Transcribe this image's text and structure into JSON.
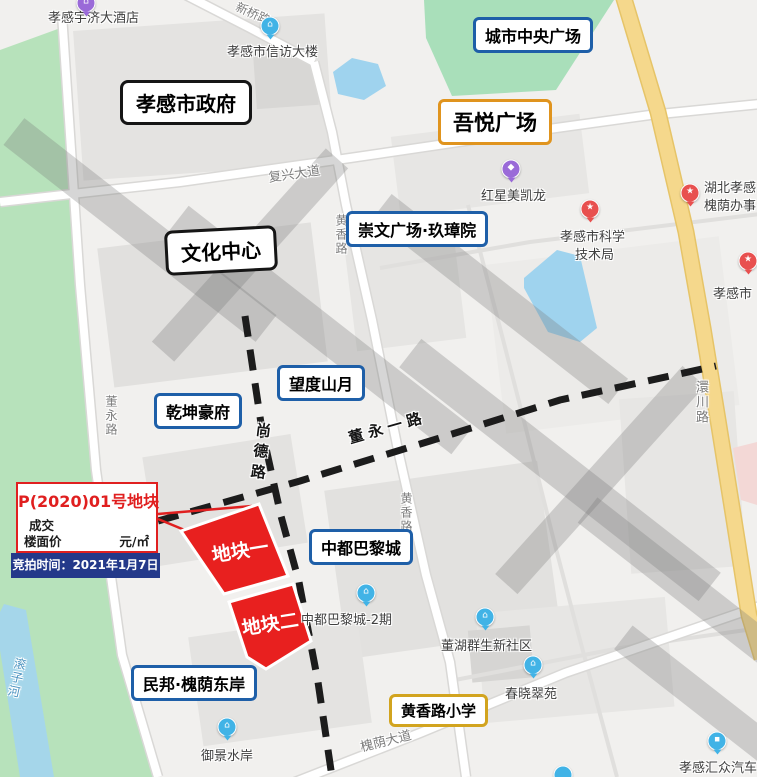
{
  "boxed_labels": [
    {
      "id": "xiaogan-government",
      "label": "孝感市政府",
      "style": "black"
    },
    {
      "id": "city-central-plaza",
      "label": "城市中央广场",
      "style": "blue"
    },
    {
      "id": "wuyue-plaza",
      "label": "吾悦广场",
      "style": "orange"
    },
    {
      "id": "culture-center",
      "label": "文化中心",
      "style": "black"
    },
    {
      "id": "chongwen-plaza-jiuzhangyuan",
      "label": "崇文广场·玖璋院",
      "style": "blue"
    },
    {
      "id": "wangdu-shanyue",
      "label": "望度山月",
      "style": "blue"
    },
    {
      "id": "qiankun-haofu",
      "label": "乾坤豪府",
      "style": "blue"
    },
    {
      "id": "zhongdu-paris-city",
      "label": "中都巴黎城",
      "style": "blue"
    },
    {
      "id": "minbang-huaiyin-east-bank",
      "label": "民邦·槐荫东岸",
      "style": "blue"
    },
    {
      "id": "huangxiang-road-primary-school",
      "label": "黄香路小学",
      "style": "gold"
    }
  ],
  "road_labels": [
    {
      "id": "xinqiao-road",
      "label": "新桥路"
    },
    {
      "id": "fuxing-avenue",
      "label": "复兴大道"
    },
    {
      "id": "dongyong-road",
      "label": "董永路"
    },
    {
      "id": "shangde-road",
      "label": "尚德路"
    },
    {
      "id": "dongyong-no1-road",
      "label": "董永一路"
    },
    {
      "id": "huangxiang-road-north",
      "label": "黄香路"
    },
    {
      "id": "huangxiang-road-south",
      "label": "黄香路"
    },
    {
      "id": "huanchuan-road",
      "label": "澴川路"
    },
    {
      "id": "huaiyin-avenue",
      "label": "槐荫大道"
    },
    {
      "id": "gunzi-river",
      "label": "滚子河"
    }
  ],
  "pois": [
    {
      "id": "yuji-grand-hotel",
      "label": "孝感宇济大酒店",
      "icon": "building",
      "pin": "purple"
    },
    {
      "id": "xinfang-building",
      "label": "孝感市信访大楼",
      "icon": "building",
      "pin": "blue"
    },
    {
      "id": "red-star-macalline",
      "label": "红星美凯龙",
      "icon": "bag",
      "pin": "purple"
    },
    {
      "id": "science-tech-bureau",
      "label": "孝感市科学",
      "label2": "技术局",
      "icon": "star",
      "pin": "red"
    },
    {
      "id": "huaiyin-office",
      "label": "湖北孝感",
      "label2": "槐荫办事",
      "icon": "star",
      "pin": "red"
    },
    {
      "id": "xiaogan-city-poi",
      "label": "孝感市",
      "icon": "star",
      "pin": "red"
    },
    {
      "id": "zhongdu-paris-phase2",
      "label": "中都巴黎城-2期",
      "icon": "building",
      "pin": "blue"
    },
    {
      "id": "donghu-qunsheng-community",
      "label": "董湖群生新社区",
      "icon": "building",
      "pin": "blue"
    },
    {
      "id": "chunxiao-cuiyuan",
      "label": "春晓翠苑",
      "icon": "building",
      "pin": "blue"
    },
    {
      "id": "yujing-shuian",
      "label": "御景水岸",
      "icon": "building",
      "pin": "blue"
    },
    {
      "id": "xiaogan-huizhong-auto",
      "label": "孝感汇众汽车",
      "icon": "car",
      "pin": "blue"
    }
  ],
  "parcels": [
    {
      "id": "parcel-1",
      "label": "地块一"
    },
    {
      "id": "parcel-2",
      "label": "地块二"
    }
  ],
  "legend": {
    "title": "P(2020)01号地块",
    "line1": "成交",
    "line2": "楼面价",
    "unit": "元/㎡",
    "auction": "竞拍时间：2021年1月7日"
  },
  "icons": {
    "star": "★",
    "building": "⌂",
    "bag": "◆",
    "car": "▪"
  },
  "colors": {
    "annotation_blue": "#1e5fa8",
    "annotation_black": "#151515",
    "annotation_orange": "#e0941e",
    "annotation_gold": "#d2a41f",
    "parcel_red": "#e8201f",
    "legend_red": "#e02020",
    "legend_bar_blue": "#24398a",
    "road_yellow": "#f5d88c",
    "park_green": "#b7e2bb",
    "water_blue": "#9fd3ee",
    "pin_red": "#e8504f",
    "pin_blue": "#41b3e6",
    "pin_purple": "#9a6ad8"
  }
}
